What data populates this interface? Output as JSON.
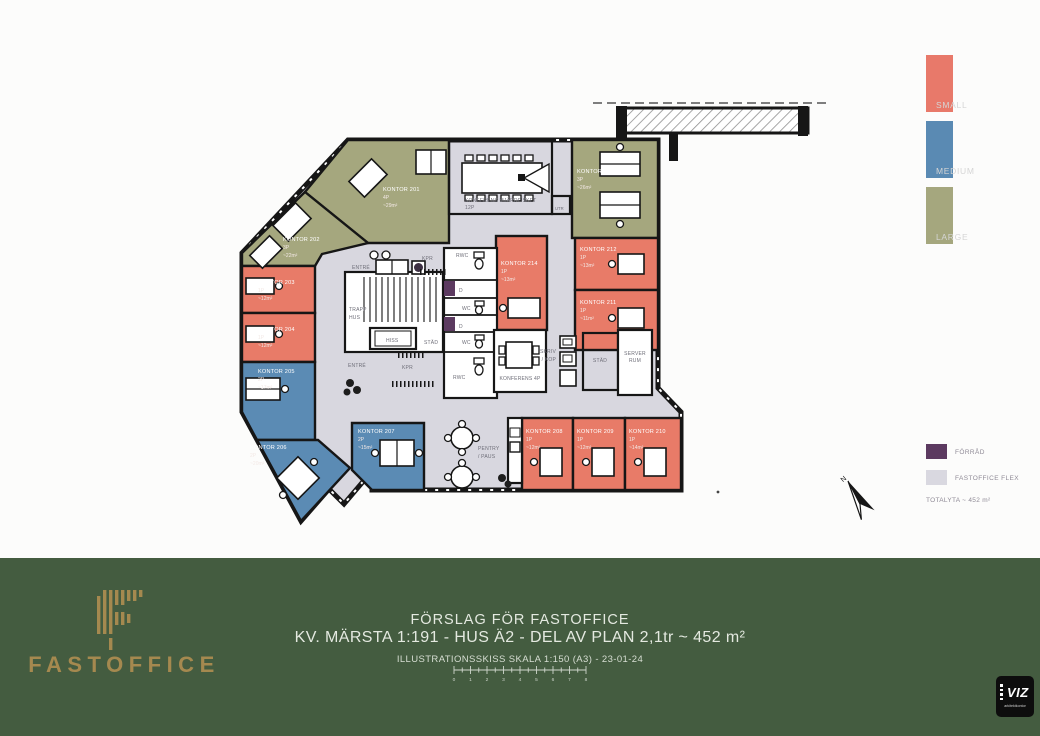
{
  "plan": {
    "rooms": [
      {
        "name": "KONTOR 201",
        "capacity": "4P",
        "area": "~29m²",
        "size": "large"
      },
      {
        "name": "KONTOR 202",
        "capacity": "3P",
        "area": "~22m²",
        "size": "large"
      },
      {
        "name": "KONTOR 203",
        "capacity": "1P",
        "area": "~12m²",
        "size": "small"
      },
      {
        "name": "KONTOR 204",
        "capacity": "1P",
        "area": "~12m²",
        "size": "small"
      },
      {
        "name": "KONTOR 205",
        "capacity": "2P",
        "area": "~17m²",
        "size": "medium"
      },
      {
        "name": "KONTOR 206",
        "capacity": "2P",
        "area": "~20m²",
        "size": "medium"
      },
      {
        "name": "KONTOR 207",
        "capacity": "2P",
        "area": "~15m²",
        "size": "medium"
      },
      {
        "name": "KONTOR 208",
        "capacity": "1P",
        "area": "~12m²",
        "size": "small"
      },
      {
        "name": "KONTOR 209",
        "capacity": "1P",
        "area": "~12m²",
        "size": "small"
      },
      {
        "name": "KONTOR 210",
        "capacity": "1P",
        "area": "~14m²",
        "size": "small"
      },
      {
        "name": "KONTOR 211",
        "capacity": "1P",
        "area": "~11m²",
        "size": "small"
      },
      {
        "name": "KONTOR 212",
        "capacity": "1P",
        "area": "~13m²",
        "size": "small"
      },
      {
        "name": "KONTOR 213",
        "capacity": "3P",
        "area": "~26m²",
        "size": "large"
      },
      {
        "name": "KONTOR 214",
        "capacity": "1P",
        "area": "~13m²",
        "size": "small"
      }
    ],
    "facilities": {
      "entre": "ENTRÉ",
      "trapp_line1": "TRAPP",
      "trapp_line2": "HUS",
      "hiss": "HISS",
      "kpr": "KPR",
      "stad": "STÄD",
      "wc": "WC",
      "rwc": "RWC",
      "d": "D",
      "utr": "UTR",
      "skriv_line1": "SKRIV",
      "skriv_line2": "/ KOP",
      "server_line1": "SERVER",
      "server_line2": "RUM",
      "pentry_line1": "PENTRY",
      "pentry_line2": "/ PAUS",
      "konferens_small": "KONFERENS 4P",
      "konferens_large_line1": "KONFERENS MJÄRDFISKET",
      "konferens_large_line2": "12P"
    },
    "compass_label": "N"
  },
  "legend_sizes": {
    "items": [
      {
        "label": "SMALL",
        "color": "#E8796A"
      },
      {
        "label": "MEDIUM",
        "color": "#5A8AB3"
      },
      {
        "label": "LARGE",
        "color": "#A5A77E"
      }
    ]
  },
  "legend_types": {
    "items": [
      {
        "label": "FÖRRÅD",
        "color": "#5C3A60"
      },
      {
        "label": "FASTOFFICE FLEX",
        "color": "#D9D8E0"
      }
    ],
    "total": "TOTALYTA ~ 452 m²"
  },
  "footer": {
    "brand": "FASTOFFICE",
    "title": "FÖRSLAG FÖR FASTOFFICE",
    "subtitle": "KV. MÄRSTA 1:191 - HUS Ä2 - DEL AV PLAN 2,1tr ~ 452 m²",
    "note": "ILLUSTRATIONSSKISS SKALA 1:150 (A3) - 23-01-24",
    "scale_ticks": [
      "0",
      "1",
      "2",
      "3",
      "4",
      "5",
      "6",
      "7",
      "8"
    ],
    "colors": {
      "background": "#445C40",
      "gold": "#A5894F"
    }
  },
  "viz_logo": {
    "name": "VIZ",
    "sub": "arkitektkontor"
  }
}
